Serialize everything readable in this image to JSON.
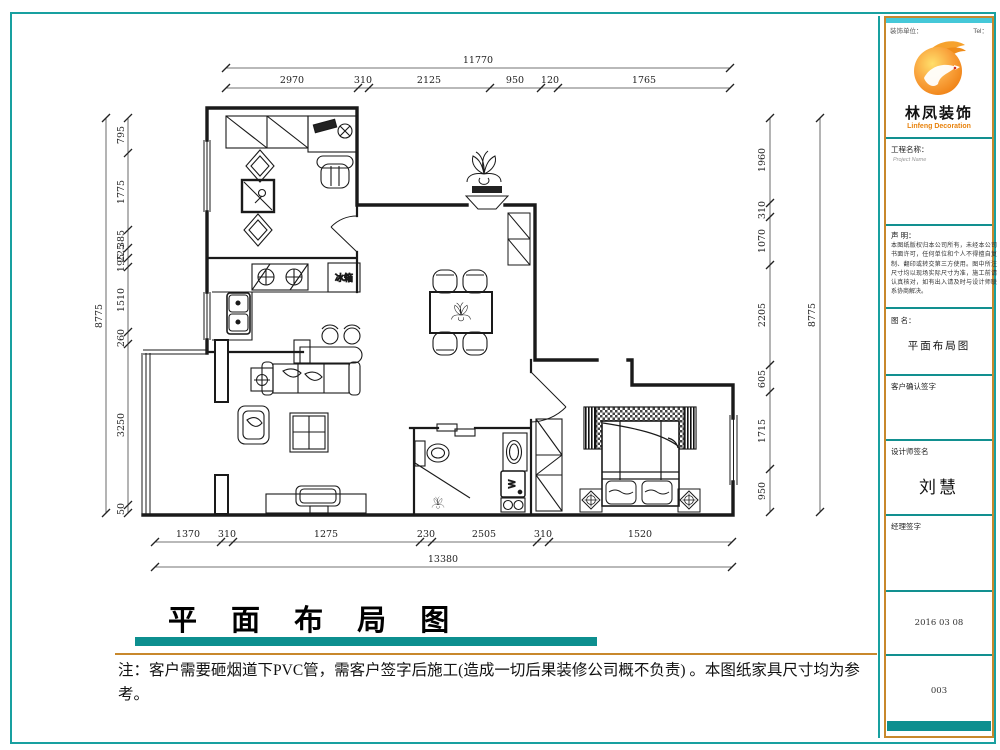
{
  "title_block": {
    "company_label": "装饰单位：",
    "tel_label": "Tel：",
    "logo_cn": "林凤装饰",
    "logo_en": "Linfeng Decoration",
    "project_label": "工程名称：",
    "project_sub": "Project Name",
    "statement_label": "声  明：",
    "statement_text": "本图纸版权归本公司所有，未经本公司书面许可，任何单位和个人不得擅自复制、翻印或转交第三方使用。图中所注尺寸均以现场实际尺寸为准，施工前请认真核对，如有出入请及时与设计师联系协商解决。",
    "drawing_name_label": "图  名：",
    "drawing_name": "平面布局图",
    "customer_sign_label": "客户确认签字",
    "designer_sign_label": "设计师签名",
    "designer_name": "刘慧",
    "manager_sign_label": "经理签字",
    "date": "2016 03 08",
    "sheet_no": "003"
  },
  "footer": {
    "title": "平 面 布 局 图",
    "note": "注：客户需要砸烟道下PVC管，需客户签字后施工(造成一切后果装修公司概不负责) 。本图纸家具尺寸均为参考。"
  },
  "plan": {
    "fridge_label": "冰箱",
    "washer_label": "W",
    "dims": {
      "top_overall": "11770",
      "top": [
        "2970",
        "310",
        "2125",
        "950",
        "120",
        "1765"
      ],
      "bottom": [
        "1370",
        "310",
        "1275",
        "230",
        "2505",
        "310",
        "1520"
      ],
      "bottom_overall": "13380",
      "left": [
        "795",
        "1775",
        "385",
        "225",
        "195",
        "1510",
        "260",
        "3250",
        "50"
      ],
      "left_overall": "8775",
      "right": [
        "1960",
        "310",
        "1070",
        "2205",
        "605",
        "1715",
        "950"
      ],
      "right_overall": "8775"
    }
  }
}
